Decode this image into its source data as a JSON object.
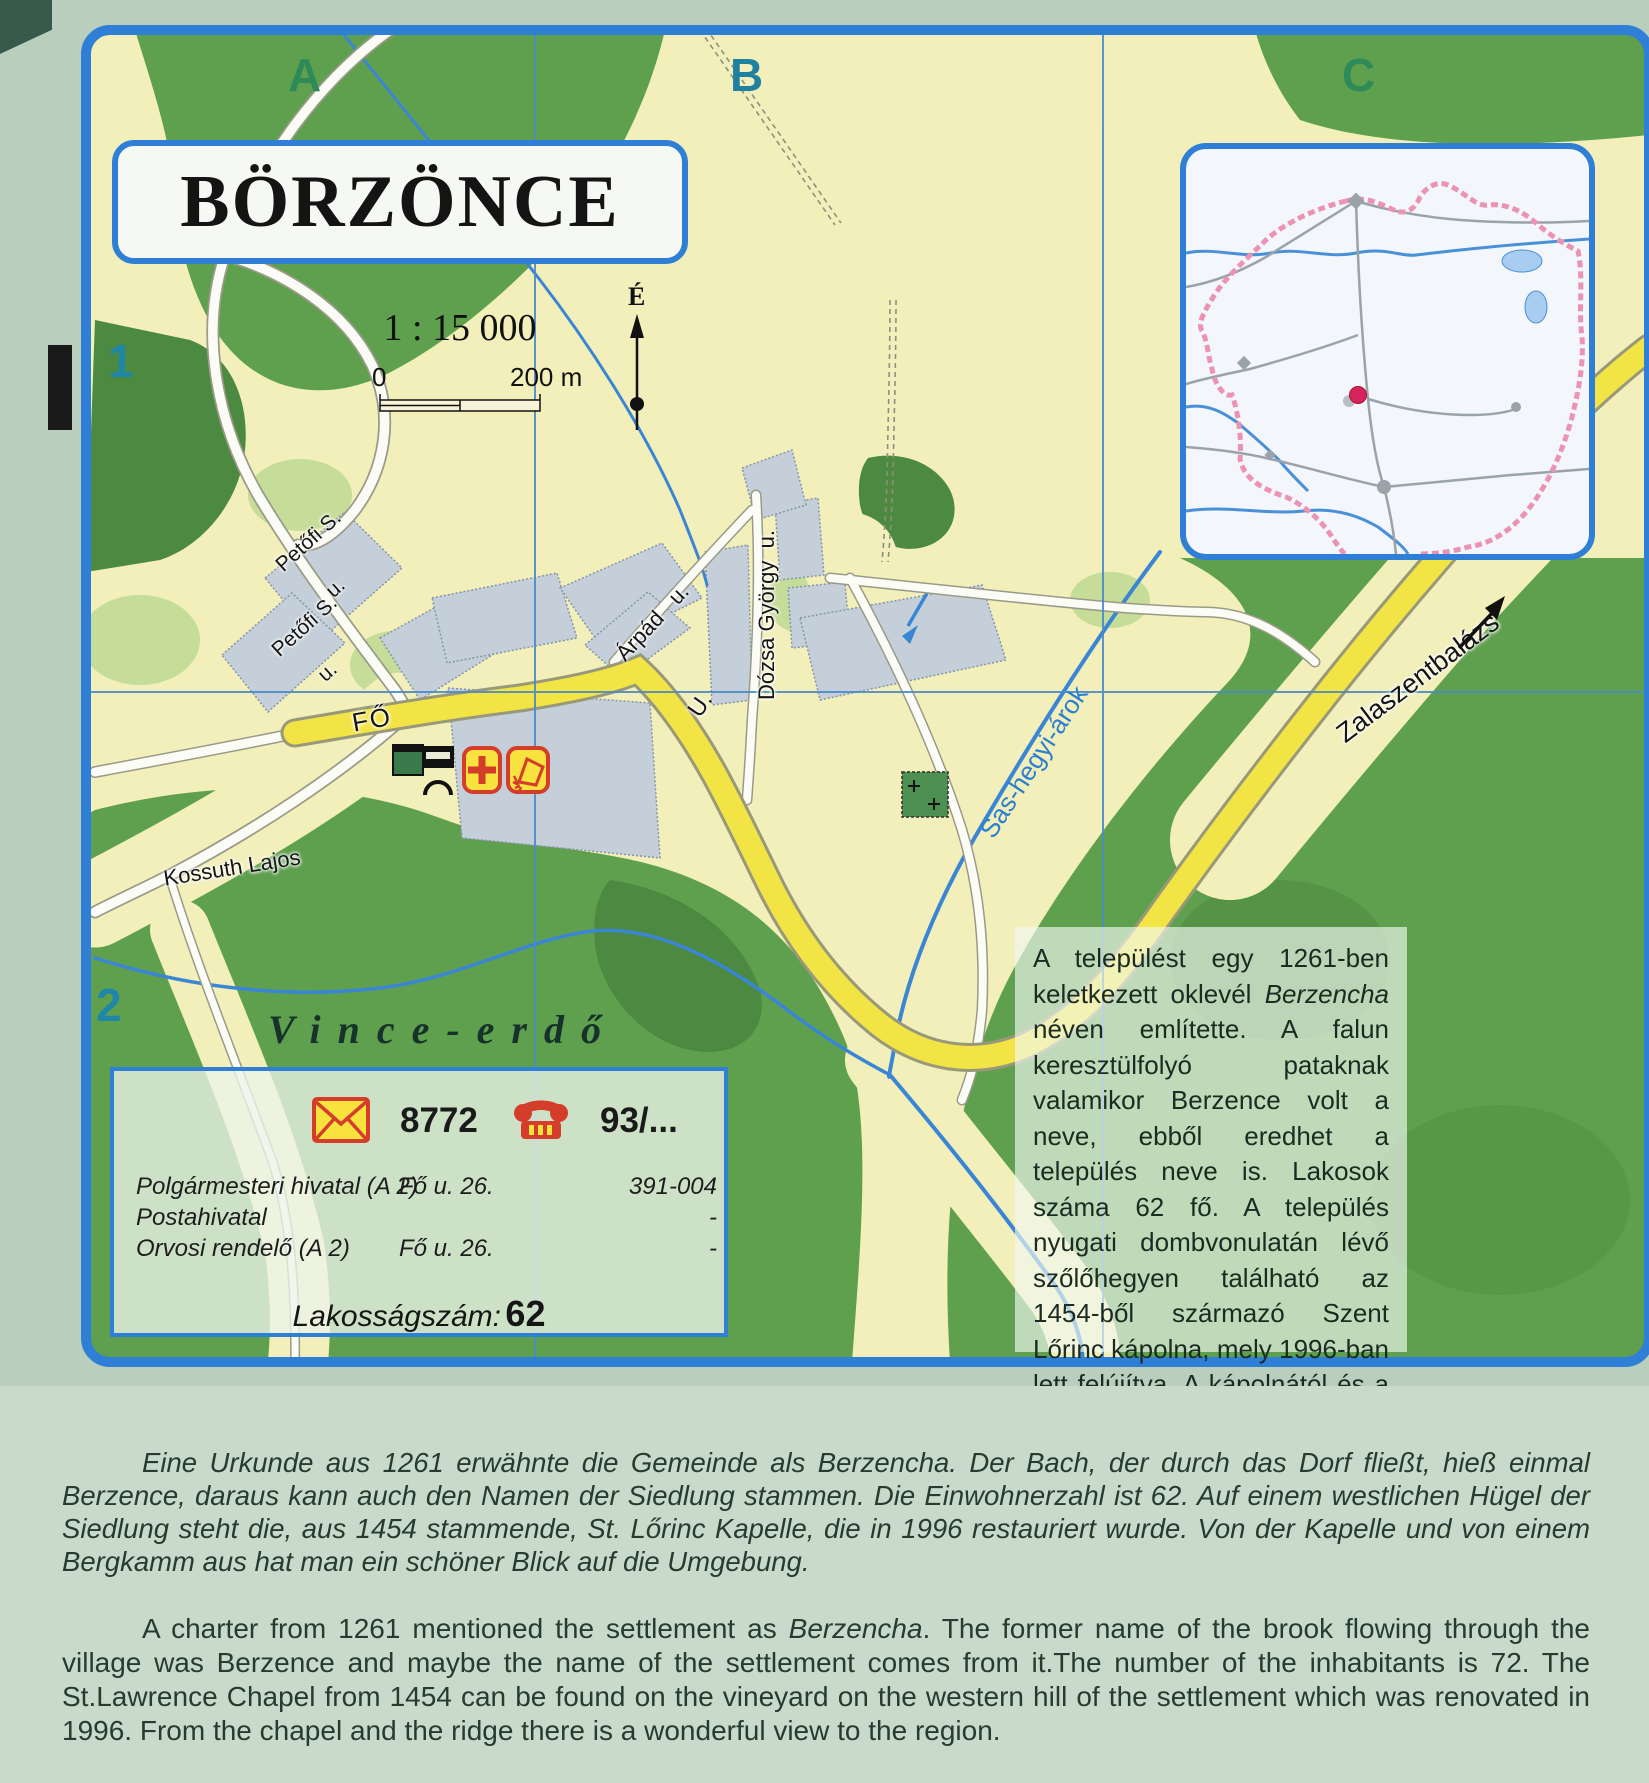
{
  "map": {
    "title": "BÖRZÖNCE",
    "scale_ratio": "1 : 15 000",
    "scale_zero": "0",
    "scale_distance": "200 m",
    "north_label": "É",
    "grid_columns": [
      "A",
      "B",
      "C"
    ],
    "grid_rows": [
      "1",
      "2"
    ],
    "street_labels": {
      "petofi_upper_line1": "Petőfi S.",
      "petofi_upper_line2": "u.",
      "petofi_lower_line1": "Petőfi S.",
      "petofi_lower_line2": "u.",
      "fo": "FŐ",
      "fo_continuation": "U.",
      "arpad": "Árpád   u.",
      "dozsa": "Dózsa György  u.",
      "kossuth": "Kossuth Lajos",
      "stream": "Sas-hegyi-árok",
      "road_exit": "Zalaszentbalázs"
    },
    "forest_label": "Vince-erdő"
  },
  "info_box": {
    "postal_code": "8772",
    "phone_prefix": "93/...",
    "rows": [
      {
        "name": "Polgármesteri hivatal (A 2)",
        "address": "Fő u. 26.",
        "phone": "391-004"
      },
      {
        "name": "Postahivatal",
        "address": "",
        "phone": "-"
      },
      {
        "name": "Orvosi rendelő (A 2)",
        "address": "Fő u. 26.",
        "phone": "-"
      }
    ],
    "population_label": "Lakosságszám:",
    "population_value": "62"
  },
  "hungarian_text": {
    "pre": "A települést egy 1261-ben keletkezett oklevél ",
    "em": "Berzencha",
    "post": " néven említette. A falun keresztülfolyó pataknak valamikor Berzence volt a neve, ebből eredhet a település neve is. Lakosok száma 62 fő. A település nyugati dombvonulatán lévő szőlőhegyen található az 1454-ből származó Szent Lőrinc kápolna, mely 1996-ban lett felújítva. A kápolnától és a hegy gerincéről szép panoráma nyílik a környékre."
  },
  "german_text": "Eine Urkunde aus 1261 erwähnte die Gemeinde als Berzencha. Der Bach, der durch das Dorf fließt, hieß einmal Berzence, daraus kann auch den Namen der Siedlung stammen. Die Einwohnerzahl ist 62. Auf einem westlichen Hügel der Siedlung steht die, aus 1454 stammende, St. Lőrinc Kapelle, die in 1996 restauriert wurde. Von der Kapelle und von einem Bergkamm aus hat man ein schöner Blick auf die Umgebung.",
  "english_text": {
    "pre": "A charter from 1261 mentioned the settlement as ",
    "em": "Berzencha",
    "post": ". The former name of the brook flowing through the village was Berzence and maybe the name of the settlement comes from it.The number of the inhabitants is 72. The St.Lawrence Chapel from 1454 can be found on the vineyard on the western hill of the settlement which was renovated in 1996. From the chapel and the ridge there is a wonderful view to the region."
  },
  "colors": {
    "frame_blue": "#2f7fd6",
    "map_base": "#f2efba",
    "forest": "#5fa04e",
    "forest_dark": "#4c8a41",
    "forest_light": "#c6dc99",
    "road_yellow": "#f3e446",
    "water_blue": "#3a86d4",
    "building_grey": "#c5cfd9",
    "boundary_pink": "#ec92b2",
    "village_dot_red": "#d6245a",
    "grid_label_green": "#2f8a5a",
    "grid_label_teal": "#2080a0"
  }
}
